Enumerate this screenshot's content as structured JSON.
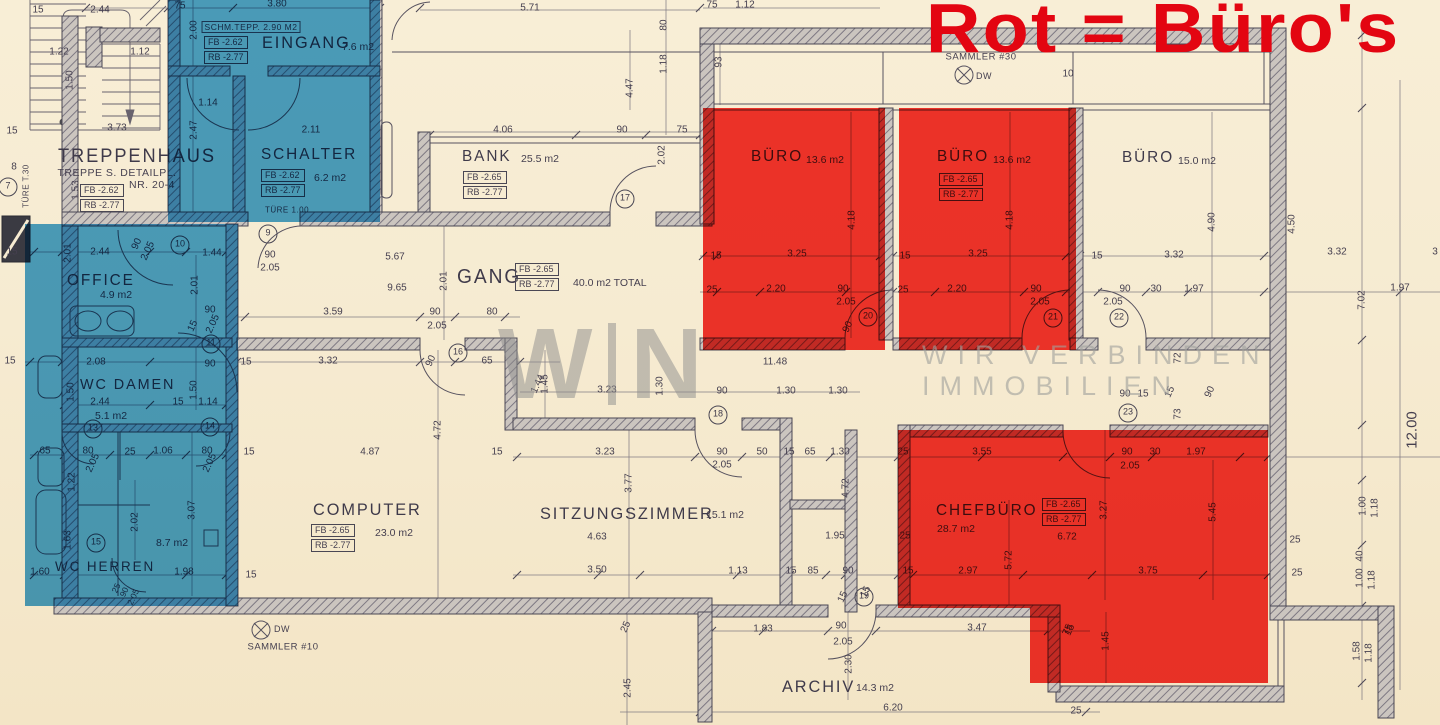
{
  "title": {
    "text": "Rot = Büro's",
    "color": "#e30511"
  },
  "watermark": {
    "w": "W",
    "n": "N",
    "line1": "WIR VERBINDEN",
    "line2": "IMMOBILIEN"
  },
  "colors": {
    "paper": "#f6ebd1",
    "line": "#4e4a58",
    "wall_fill": "#cbc5bf",
    "highlight_blue": "#42a0d8",
    "highlight_red": "#f32b24",
    "title_red": "#e30511",
    "watermark_gray": "#8d8d8d"
  },
  "highlights": {
    "blue_rooms": [
      "eingang",
      "schalter",
      "office",
      "wc-damen",
      "wc-herren"
    ],
    "red_rooms": [
      "buero-1",
      "buero-2",
      "chefbuero"
    ]
  },
  "rooms": [
    {
      "key": "treppenhaus",
      "name": "TREPPENHAUS",
      "nx": 58,
      "ny": 146,
      "ns": 19,
      "fb": "FB -2.62",
      "rb": "RB -2.77",
      "bx": 80,
      "by": 184
    },
    {
      "key": "eingang",
      "name": "EINGANG",
      "area": "7.6 m2",
      "nx": 262,
      "ny": 33,
      "ns": 17,
      "ax": 342,
      "ay": 41,
      "fb": "FB -2.62",
      "rb": "RB -2.77",
      "bx": 204,
      "by": 36
    },
    {
      "key": "schalter",
      "name": "SCHALTER",
      "area": "6.2 m2",
      "nx": 261,
      "ny": 146,
      "ns": 16,
      "ax": 314,
      "ay": 172,
      "fb": "FB -2.62",
      "rb": "RB -2.77",
      "bx": 261,
      "by": 169
    },
    {
      "key": "bank",
      "name": "BANK",
      "area": "25.5 m2",
      "nx": 462,
      "ny": 148,
      "ns": 16,
      "ax": 521,
      "ay": 153,
      "fb": "FB -2.65",
      "rb": "RB -2.77",
      "bx": 463,
      "by": 171
    },
    {
      "key": "gang",
      "name": "GANG",
      "area": "40.0 m2 TOTAL",
      "nx": 457,
      "ny": 266,
      "ns": 20,
      "ax": 573,
      "ay": 277,
      "fb": "FB -2.65",
      "rb": "RB -2.77",
      "bx": 515,
      "by": 263
    },
    {
      "key": "office",
      "name": "OFFICE",
      "area": "4.9 m2",
      "nx": 67,
      "ny": 272,
      "ns": 16,
      "ax": 100,
      "ay": 289
    },
    {
      "key": "wc-damen",
      "name": "WC DAMEN",
      "area": "5.1 m2",
      "nx": 80,
      "ny": 376,
      "ns": 15,
      "ax": 95,
      "ay": 410
    },
    {
      "key": "wc-herren",
      "name": "WC HERREN",
      "area": "8.7 m2",
      "nx": 55,
      "ny": 558,
      "ns": 14,
      "ax": 156,
      "ay": 537
    },
    {
      "key": "computer",
      "name": "COMPUTER",
      "area": "23.0 m2",
      "nx": 313,
      "ny": 500,
      "ns": 17,
      "ax": 375,
      "ay": 527,
      "fb": "FB -2.65",
      "rb": "RB -2.77",
      "bx": 311,
      "by": 524
    },
    {
      "key": "sitzungszimmer",
      "name": "SITZUNGSZIMMER",
      "area": "15.1 m2",
      "nx": 540,
      "ny": 504,
      "ns": 17,
      "ax": 706,
      "ay": 509
    },
    {
      "key": "buero-1",
      "name": "BÜRO",
      "area": "13.6 m2",
      "nx": 751,
      "ny": 148,
      "ns": 16,
      "ax": 806,
      "ay": 154
    },
    {
      "key": "buero-2",
      "name": "BÜRO",
      "area": "13.6 m2",
      "nx": 937,
      "ny": 148,
      "ns": 16,
      "ax": 993,
      "ay": 154,
      "fb": "FB -2.65",
      "rb": "RB -2.77",
      "bx": 939,
      "by": 173
    },
    {
      "key": "buero-3",
      "name": "BÜRO",
      "area": "15.0 m2",
      "nx": 1122,
      "ny": 149,
      "ns": 16,
      "ax": 1178,
      "ay": 155
    },
    {
      "key": "chefbuero",
      "name": "CHEFBÜRO",
      "area": "28.7 m2",
      "nx": 936,
      "ny": 502,
      "ns": 16,
      "ax": 937,
      "ay": 523,
      "fb": "FB -2.65",
      "rb": "RB -2.77",
      "bx": 1042,
      "by": 498
    },
    {
      "key": "archiv",
      "name": "ARCHIV",
      "area": "14.3 m2",
      "nx": 782,
      "ny": 677,
      "ns": 17,
      "ax": 856,
      "ay": 682
    }
  ],
  "notes": [
    {
      "t": "TREPPE S. DETAILPL.",
      "x": 117,
      "y": 173,
      "s": 10.5
    },
    {
      "t": "NR. 20-4",
      "x": 152,
      "y": 185,
      "s": 10.5
    },
    {
      "t": "SCHM.TEPP. 2.90 M2",
      "x": 251,
      "y": 27,
      "s": 8.5,
      "box": 1
    },
    {
      "t": "TÜRE T.30",
      "x": 26,
      "y": 186,
      "s": 8,
      "r": -90
    },
    {
      "t": "TÜRE 1.00",
      "x": 287,
      "y": 210,
      "s": 8
    },
    {
      "t": "SAMMLER #30",
      "x": 981,
      "y": 57,
      "s": 9.5
    },
    {
      "t": "DW",
      "x": 984,
      "y": 76,
      "s": 9
    },
    {
      "t": "SAMMLER #10",
      "x": 283,
      "y": 647,
      "s": 9.5
    },
    {
      "t": "DW",
      "x": 282,
      "y": 629,
      "s": 9
    }
  ],
  "door_numbers": [
    {
      "n": "7",
      "x": 8,
      "y": 187
    },
    {
      "n": "9",
      "x": 268,
      "y": 234
    },
    {
      "n": "10",
      "x": 180,
      "y": 245
    },
    {
      "n": "11",
      "x": 211,
      "y": 344
    },
    {
      "n": "13",
      "x": 93,
      "y": 429
    },
    {
      "n": "14",
      "x": 210,
      "y": 427
    },
    {
      "n": "15",
      "x": 96,
      "y": 543
    },
    {
      "n": "16",
      "x": 458,
      "y": 353
    },
    {
      "n": "17",
      "x": 625,
      "y": 199
    },
    {
      "n": "18",
      "x": 718,
      "y": 415
    },
    {
      "n": "19",
      "x": 864,
      "y": 597
    },
    {
      "n": "20",
      "x": 868,
      "y": 317
    },
    {
      "n": "21",
      "x": 1053,
      "y": 318
    },
    {
      "n": "22",
      "x": 1119,
      "y": 318
    },
    {
      "n": "23",
      "x": 1128,
      "y": 413
    }
  ],
  "dimensions_format": "[text, x, y, rotationDeg, fontPx]",
  "dimensions": [
    [
      "15",
      38,
      10
    ],
    [
      "2.44",
      100,
      10
    ],
    [
      "75",
      180,
      6
    ],
    [
      "3.80",
      277,
      4
    ],
    [
      "2.00",
      194,
      30,
      -90
    ],
    [
      "1.22",
      59,
      52
    ],
    [
      "1.12",
      140,
      52
    ],
    [
      "1.50",
      70,
      80,
      -90
    ],
    [
      "3.73",
      117,
      128
    ],
    [
      "2.47",
      194,
      130,
      -90
    ],
    [
      "15",
      12,
      131
    ],
    [
      "1.53",
      76,
      190,
      -90
    ],
    [
      "8",
      14,
      167
    ],
    [
      "1.14",
      208,
      103
    ],
    [
      "2.11",
      311,
      130
    ],
    [
      "5.71",
      530,
      8
    ],
    [
      "80",
      664,
      25,
      -90
    ],
    [
      "1.18",
      664,
      64,
      -90
    ],
    [
      "4.47",
      630,
      88,
      -90
    ],
    [
      "4.06",
      503,
      130
    ],
    [
      "90",
      622,
      130
    ],
    [
      "75",
      682,
      130
    ],
    [
      "2.02",
      662,
      155,
      -90
    ],
    [
      "75",
      712,
      5
    ],
    [
      "1.12",
      745,
      5
    ],
    [
      "93",
      719,
      62,
      -90
    ],
    [
      "10",
      1068,
      74
    ],
    [
      "4.18",
      852,
      220,
      -90
    ],
    [
      "3.25",
      797,
      254
    ],
    [
      "15",
      716,
      256
    ],
    [
      "25",
      712,
      290
    ],
    [
      "2.20",
      776,
      289
    ],
    [
      "90",
      843,
      289
    ],
    [
      "2.05",
      846,
      302
    ],
    [
      "90",
      848,
      327,
      -65
    ],
    [
      "4.18",
      1010,
      220,
      -90
    ],
    [
      "3.25",
      978,
      254
    ],
    [
      "15",
      905,
      256
    ],
    [
      "25",
      903,
      290
    ],
    [
      "2.20",
      957,
      289
    ],
    [
      "90",
      1036,
      289
    ],
    [
      "2.05",
      1040,
      302
    ],
    [
      "4.90",
      1212,
      222,
      -90
    ],
    [
      "3.32",
      1174,
      255
    ],
    [
      "15",
      1097,
      256
    ],
    [
      "90",
      1125,
      289
    ],
    [
      "30",
      1156,
      289
    ],
    [
      "1.97",
      1194,
      289
    ],
    [
      "2.05",
      1113,
      302
    ],
    [
      "3.32",
      1337,
      252
    ],
    [
      "3",
      1435,
      252
    ],
    [
      "1.97",
      1400,
      288
    ],
    [
      "7.02",
      1362,
      300,
      -90
    ],
    [
      "12.00",
      1412,
      430,
      -90,
      15
    ],
    [
      "4.50",
      1292,
      224,
      -90
    ],
    [
      "72",
      1178,
      358,
      -90
    ],
    [
      "90",
      1125,
      394
    ],
    [
      "15",
      1143,
      394
    ],
    [
      "15",
      1170,
      392,
      -65
    ],
    [
      "90",
      1210,
      392,
      -65
    ],
    [
      "73",
      1178,
      414,
      -90
    ],
    [
      "1.00",
      1363,
      506,
      -90
    ],
    [
      "1.18",
      1375,
      508,
      -90
    ],
    [
      "25",
      1295,
      540
    ],
    [
      "40",
      1360,
      556,
      -90
    ],
    [
      "90",
      270,
      255
    ],
    [
      "2.05",
      270,
      268
    ],
    [
      "5.67",
      395,
      257
    ],
    [
      "9.65",
      397,
      288
    ],
    [
      "2.01",
      444,
      281,
      -90
    ],
    [
      "3.59",
      333,
      312
    ],
    [
      "90",
      435,
      312
    ],
    [
      "2.05",
      437,
      326
    ],
    [
      "80",
      492,
      312
    ],
    [
      "1.44",
      538,
      384,
      -65
    ],
    [
      "1.30",
      660,
      386,
      -90
    ],
    [
      "3.23",
      607,
      390
    ],
    [
      "90",
      722,
      391
    ],
    [
      "1.30",
      786,
      391
    ],
    [
      "1.30",
      838,
      391
    ],
    [
      "11.48",
      775,
      362
    ],
    [
      "3.23",
      605,
      452
    ],
    [
      "90",
      722,
      452
    ],
    [
      "2.05",
      722,
      465
    ],
    [
      "50",
      762,
      452
    ],
    [
      "15",
      789,
      452
    ],
    [
      "65",
      810,
      452
    ],
    [
      "1.30",
      840,
      452
    ],
    [
      "3.77",
      629,
      483,
      -90
    ],
    [
      "4.63",
      597,
      537
    ],
    [
      "3.50",
      597,
      570
    ],
    [
      "1.13",
      738,
      571
    ],
    [
      "15",
      791,
      571
    ],
    [
      "85",
      813,
      571
    ],
    [
      "90",
      848,
      571
    ],
    [
      "4.72",
      846,
      488,
      -90
    ],
    [
      "1.95",
      835,
      536
    ],
    [
      "15",
      866,
      592,
      -65
    ],
    [
      "15",
      246,
      362
    ],
    [
      "3.32",
      328,
      361
    ],
    [
      "90",
      431,
      361,
      -65
    ],
    [
      "65",
      487,
      361
    ],
    [
      "4.72",
      438,
      430,
      -90
    ],
    [
      "4.87",
      370,
      452
    ],
    [
      "15",
      249,
      452
    ],
    [
      "15",
      497,
      452
    ],
    [
      "1.45",
      545,
      384,
      -90
    ],
    [
      "15",
      251,
      575
    ],
    [
      "15",
      12,
      252
    ],
    [
      "2.01",
      68,
      253,
      -90
    ],
    [
      "2.44",
      100,
      252
    ],
    [
      "90",
      137,
      244,
      -65
    ],
    [
      "2.05",
      148,
      251,
      -65
    ],
    [
      "1.44",
      212,
      253
    ],
    [
      "2.01",
      195,
      285,
      -90
    ],
    [
      "90",
      210,
      310
    ],
    [
      "2.05",
      213,
      324,
      -65
    ],
    [
      "15",
      193,
      326,
      -65
    ],
    [
      "90",
      210,
      364
    ],
    [
      "2.08",
      96,
      362
    ],
    [
      "15",
      10,
      361
    ],
    [
      "2.44",
      100,
      402
    ],
    [
      "1.50",
      71,
      392,
      -90
    ],
    [
      "1.50",
      194,
      390,
      -90
    ],
    [
      "15",
      178,
      402
    ],
    [
      "1.14",
      208,
      402
    ],
    [
      "65",
      45,
      451
    ],
    [
      "80",
      88,
      451
    ],
    [
      "2.05",
      93,
      463,
      -65
    ],
    [
      "25",
      130,
      452
    ],
    [
      "1.06",
      163,
      451
    ],
    [
      "80",
      207,
      451
    ],
    [
      "2.05",
      210,
      463,
      -65
    ],
    [
      "1.22",
      72,
      482,
      -90
    ],
    [
      "3.07",
      192,
      510,
      -90
    ],
    [
      "1.63",
      68,
      540,
      -90
    ],
    [
      "2.02",
      135,
      522,
      -90
    ],
    [
      "1.60",
      40,
      572
    ],
    [
      "1.98",
      184,
      572
    ],
    [
      "25",
      116,
      588,
      -65,
      8.5
    ],
    [
      "90",
      124,
      592,
      -65,
      8.5
    ],
    [
      "2.05",
      133,
      597,
      -65,
      8.5
    ],
    [
      "1.83",
      763,
      629
    ],
    [
      "90",
      841,
      626
    ],
    [
      "2.05",
      843,
      642
    ],
    [
      "2.30",
      849,
      664,
      -90
    ],
    [
      "3.47",
      977,
      628
    ],
    [
      "15",
      1070,
      630,
      -65
    ],
    [
      "6.20",
      893,
      708
    ],
    [
      "25",
      626,
      627,
      -65
    ],
    [
      "2.45",
      628,
      688,
      -90
    ],
    [
      "15",
      843,
      597,
      -65
    ],
    [
      "3.55",
      982,
      452
    ],
    [
      "90",
      1127,
      452
    ],
    [
      "2.05",
      1130,
      466
    ],
    [
      "30",
      1155,
      452
    ],
    [
      "1.97",
      1196,
      452
    ],
    [
      "25",
      903,
      452
    ],
    [
      "5.45",
      1213,
      512,
      -90
    ],
    [
      "3.27",
      1104,
      510,
      -90
    ],
    [
      "6.72",
      1067,
      537
    ],
    [
      "25",
      905,
      536
    ],
    [
      "15",
      908,
      571
    ],
    [
      "2.97",
      968,
      571
    ],
    [
      "5.72",
      1009,
      560,
      -90
    ],
    [
      "3.75",
      1148,
      571
    ],
    [
      "1.45",
      1106,
      641,
      -90
    ],
    [
      "75",
      1068,
      630,
      -65
    ],
    [
      "25",
      1297,
      573
    ],
    [
      "25",
      1076,
      711
    ],
    [
      "1.00",
      1360,
      578,
      -90
    ],
    [
      "1.18",
      1372,
      580,
      -90
    ],
    [
      "1.58",
      1357,
      651,
      -90
    ],
    [
      "1.18",
      1369,
      653,
      -90
    ]
  ]
}
